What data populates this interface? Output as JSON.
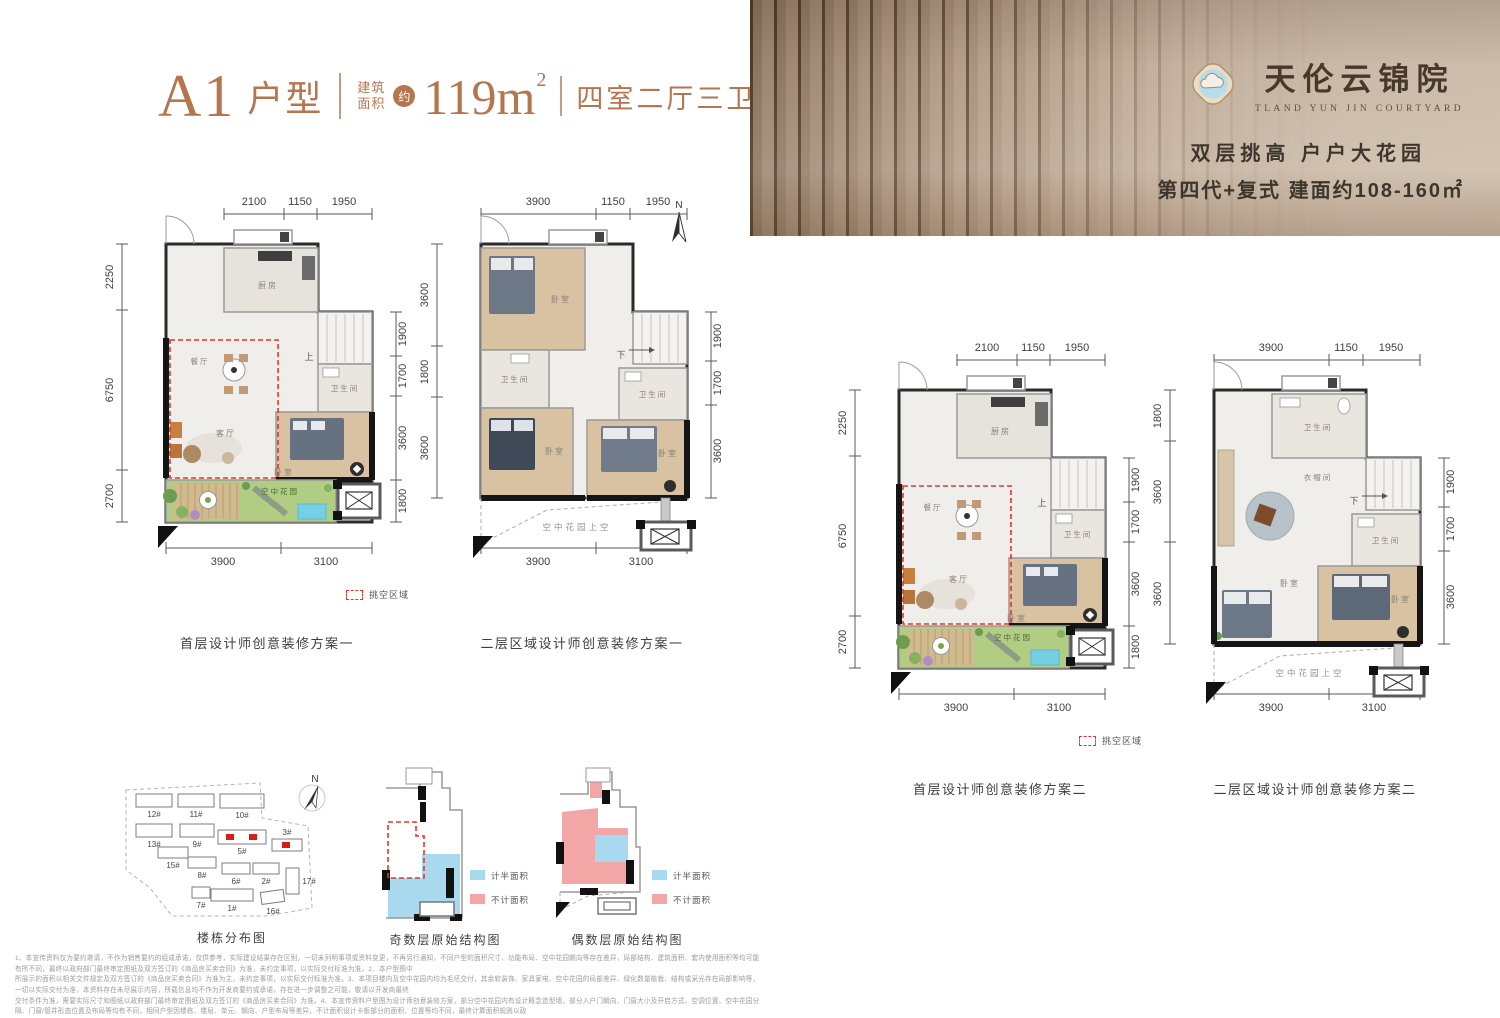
{
  "header": {
    "unit": "A1",
    "unit_suffix": "户型",
    "area_label_1": "建筑",
    "area_label_2": "面积",
    "approx_badge": "约",
    "area_value": "119m",
    "area_sup": "2",
    "rooms": "四室二厅三卫"
  },
  "banner": {
    "logo_title": "天伦云锦院",
    "logo_subtitle": "TLAND YUN JIN COURTYARD",
    "tagline1": "双层挑高 户户大花园",
    "tagline2": "第四代+复式  建面约108-160㎡"
  },
  "compass_label": "N",
  "void_legend_label": "挑空区域",
  "plans": [
    {
      "caption": "首层设计师创意装修方案一",
      "dims": {
        "top": [
          "2100",
          "1150",
          "1950"
        ],
        "left": [
          "2250",
          "6750",
          "2700"
        ],
        "right": [
          "1900",
          "1700",
          "3600",
          "1800"
        ],
        "bottom": [
          "3900",
          "3100"
        ]
      },
      "labels": {
        "kitchen": "厨房",
        "dining": "餐厅",
        "living": "客厅",
        "bedroom": "卧室",
        "bath": "卫生间",
        "stair": "上",
        "garden": "空中花园"
      }
    },
    {
      "caption": "二层区域设计师创意装修方案一",
      "dims": {
        "top": [
          "3900",
          "1150",
          "1950"
        ],
        "left": [
          "3600",
          "1800",
          "3600"
        ],
        "right": [
          "1900",
          "1700",
          "3600"
        ],
        "bottom": [
          "3900",
          "3100"
        ]
      },
      "labels": {
        "bedroom1": "卧室",
        "bedroom2": "卧室",
        "bedroom3": "卧室",
        "bath1": "卫生间",
        "bath2": "卫生间",
        "stair": "下",
        "void": "空中花园上空"
      }
    },
    {
      "caption": "首层设计师创意装修方案二",
      "dims": {
        "top": [
          "2100",
          "1150",
          "1950"
        ],
        "left": [
          "2250",
          "6750",
          "2700"
        ],
        "right": [
          "1900",
          "1700",
          "3600",
          "1800"
        ],
        "bottom": [
          "3900",
          "3100"
        ]
      },
      "labels": {
        "kitchen": "厨房",
        "dining": "餐厅",
        "living": "客厅",
        "bedroom": "卧室",
        "bath": "卫生间",
        "stair": "上",
        "garden": "空中花园"
      }
    },
    {
      "caption": "二层区域设计师创意装修方案二",
      "dims": {
        "top": [
          "3900",
          "1150",
          "1950"
        ],
        "left": [
          "1800",
          "3600",
          "3600"
        ],
        "right": [
          "1900",
          "1700",
          "3600"
        ],
        "bottom": [
          "3900",
          "3100"
        ]
      },
      "labels": {
        "bath1": "卫生间",
        "cloak": "衣帽间",
        "stair": "下",
        "bath2": "卫生间",
        "bedroom1": "卧室",
        "bedroom2": "卧室",
        "void": "空中花园上空"
      }
    }
  ],
  "siteplan": {
    "caption": "楼栋分布图",
    "buildings": [
      {
        "label": "12#"
      },
      {
        "label": "11#"
      },
      {
        "label": "10#"
      },
      {
        "label": "13#"
      },
      {
        "label": "9#"
      },
      {
        "label": "5#"
      },
      {
        "label": "3#"
      },
      {
        "label": "15#"
      },
      {
        "label": "8#"
      },
      {
        "label": "6#"
      },
      {
        "label": "2#"
      },
      {
        "label": "17#"
      },
      {
        "label": "7#"
      },
      {
        "label": "1#"
      },
      {
        "label": "16#"
      }
    ]
  },
  "structural": {
    "odd_caption": "奇数层原始结构图",
    "even_caption": "偶数层原始结构图",
    "legend_half": "计半面积",
    "legend_excluded": "不计面积"
  },
  "disclaimer": {
    "lines": [
      "1、本宣传资料仅为要约邀请，不作为销售要约的组成承诺，仅供参考，实际建设结果存在区别，一切未列明事项或资料变更，不再另行通知，不同户型的面积尺寸、功能布局、空中花园朝向等存在差异，局部结构、建筑面积、套内使用面积等均可能有所不同，最终以政府部门最终审定图纸及双方签订的《商品房买卖合同》为准，未约定事项，以实际交付标准为准。2、本户型图中",
      "所展示的面积以相关文件规定及双方签订的《商品房买卖合同》为准为主，未约定事项，以实际交付标准为准。3、本项目楼内及空中花园内均为毛坯交付，其余软装饰、家具家电、空中花园的局部差异、绿化数量植栽、结构或采光存在局部影响等，一切以实际交付为准，本资料存在未尽展示内容，所载信息均不作为开发商要约或承诺，存在进一步调整之可能，敬请以开发商最终",
      "交付条件为准，需要实际尺寸和图纸以政府部门最终审定图纸及双方签订的《商品房买卖合同》为准。4、本宣传资料户型图为设计师创意装修方案，部分空中花园内有设计概念造型墙，部分入户门朝向、门窗大小及开启方式、空调位置、空中花园分隔、门窗/管井形态位置及布局等均有不同，相同户型因楼栋、楼层、单元、朝向、户型布局等差异，不计面积设计卡板部分的面积、位置等均不同，最终计算面积规则以政",
      "府相关规定示意并非交付标准，本资料所展示的装修效果（包括但不限于空中花园）仅为设计创意装修基础方案，不作为交付标准。5、因建筑物立面结构、设施、构筑物形状设计需要等原因，图纸设计交付尺寸、后期设计调整，不再另行通知。本资料所标注之面积均为建筑面积，所示户型图标注以轴线尺寸为准，可能存在细微差异，所有标注尺寸数据均不排除因政府规定、规划及出卖人分期规划未能控制等原因而发生变化。",
      "6、本宣传资料于2025年x月制作，本公司保留最终修改权力，敬请留意最新资料。7、本项目推广名为：天伦云锦院，地名办核准名为：云锦院，开发商：天伦地产，营销代理机构：湖南雅也。"
    ]
  }
}
